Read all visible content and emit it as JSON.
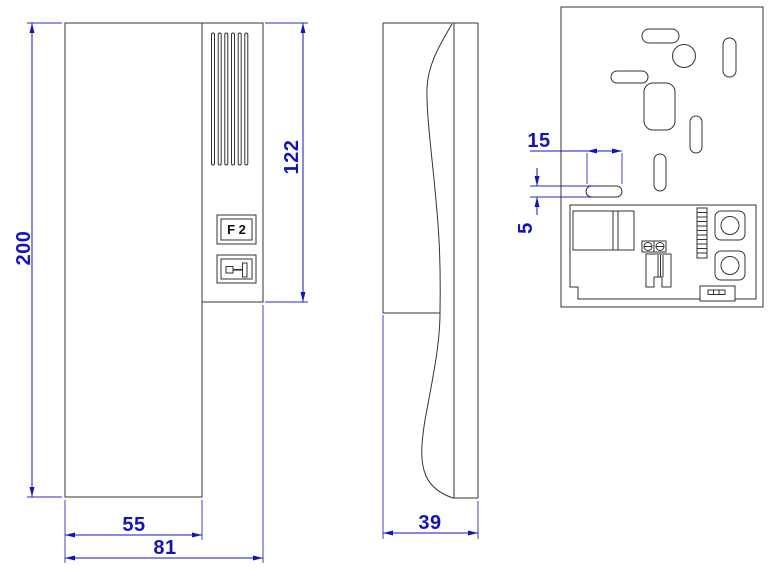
{
  "page": {
    "background": "#ffffff"
  },
  "drawing": {
    "kind": "door-phone-handset-dimension-drawing",
    "colors": {
      "dimension_blue": "#1414b8",
      "line_dark": "#333333"
    },
    "views": {
      "front": {
        "dims": {
          "height": "200",
          "panel_height": "122",
          "handset_width": "55",
          "total_width": "81"
        },
        "f2_button_label": "F 2"
      },
      "side": {
        "dims": {
          "depth": "39"
        }
      },
      "back": {
        "dims": {
          "slot_width": "15",
          "slot_height": "5"
        }
      }
    }
  }
}
